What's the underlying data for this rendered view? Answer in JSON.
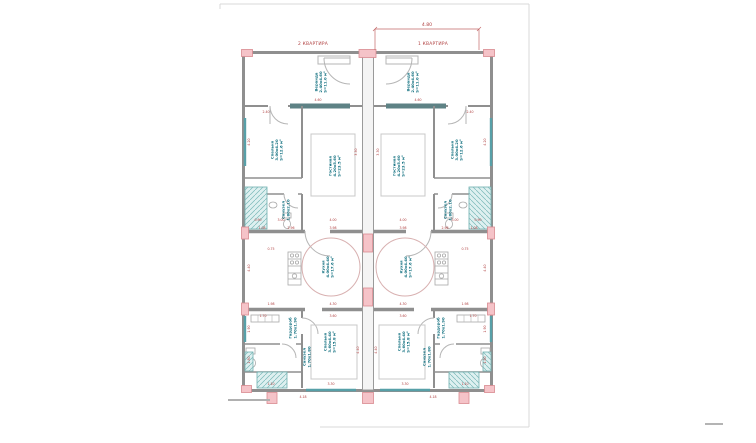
{
  "drawing": {
    "top_dimension": "4.80",
    "unit_labels": {
      "left": "2 КВАРТИРА",
      "right": "1 КВАРТИРА"
    }
  },
  "colors": {
    "dimension_red": "#b04040",
    "room_label_teal": "#0e6e7e",
    "column_pink": "#f5c3c8",
    "window_teal": "#57a0a8",
    "balcony_hatch": "#6fb0b0",
    "wall_gray": "#8f8f8f",
    "sheet_frame": "#d8d8d8"
  },
  "room_labels": [
    {
      "name": "Веранда",
      "dims": "2.40х4.60",
      "area": "S=11.0 м²",
      "x": 322,
      "y": 82,
      "rot": -90
    },
    {
      "name": "Веранда",
      "dims": "2.40х4.60",
      "area": "S=11.0 м²",
      "x": 414,
      "y": 82,
      "rot": -90
    },
    {
      "name": "Спальня",
      "dims": "3.00х4.20",
      "area": "S=12.6 м²",
      "x": 278,
      "y": 150,
      "rot": -90
    },
    {
      "name": "Спальня",
      "dims": "3.00х4.20",
      "area": "S=12.6 м²",
      "x": 458,
      "y": 150,
      "rot": -90
    },
    {
      "name": "Гостиная",
      "dims": "4.20х5.60",
      "area": "S=23.5 м²",
      "x": 336,
      "y": 166,
      "rot": -90
    },
    {
      "name": "Гостиная",
      "dims": "4.20х5.60",
      "area": "S=23.5 м²",
      "x": 400,
      "y": 166,
      "rot": -90
    },
    {
      "name": "Санузел",
      "dims": "1.80х2.10",
      "area": "",
      "x": 287,
      "y": 210,
      "rot": -90
    },
    {
      "name": "Санузел",
      "dims": "1.80х2.10",
      "area": "",
      "x": 449,
      "y": 210,
      "rot": -90
    },
    {
      "name": "Кухня",
      "dims": "4.00х4.40",
      "area": "S=17.6 м²",
      "x": 329,
      "y": 267,
      "rot": -90
    },
    {
      "name": "Кухня",
      "dims": "4.00х4.40",
      "area": "S=17.6 м²",
      "x": 407,
      "y": 267,
      "rot": -90
    },
    {
      "name": "Гардероб",
      "dims": "1.70х1.90",
      "area": "",
      "x": 294,
      "y": 328,
      "rot": -90
    },
    {
      "name": "Гардероб",
      "dims": "1.70х1.90",
      "area": "",
      "x": 442,
      "y": 328,
      "rot": -90
    },
    {
      "name": "Санузел",
      "dims": "1.70х1.80",
      "area": "",
      "x": 308,
      "y": 357,
      "rot": -90
    },
    {
      "name": "Санузел",
      "dims": "1.70х1.80",
      "area": "",
      "x": 428,
      "y": 357,
      "rot": -90
    },
    {
      "name": "Спальня",
      "dims": "3.60х4.40",
      "area": "S=15.8 м²",
      "x": 331,
      "y": 342,
      "rot": -90
    },
    {
      "name": "Спальня",
      "dims": "3.60х4.40",
      "area": "S=15.8 м²",
      "x": 405,
      "y": 342,
      "rot": -90
    }
  ],
  "dimensions": [
    {
      "t": "4.60",
      "x": 318,
      "y": 101
    },
    {
      "t": "4.60",
      "x": 418,
      "y": 101
    },
    {
      "t": "2.40",
      "x": 266,
      "y": 113
    },
    {
      "t": "2.40",
      "x": 470,
      "y": 113
    },
    {
      "t": "4.20",
      "x": 250,
      "y": 142,
      "r": -90
    },
    {
      "t": "4.20",
      "x": 486,
      "y": 142,
      "r": -90
    },
    {
      "t": "3.30",
      "x": 357,
      "y": 152,
      "r": -90
    },
    {
      "t": "3.30",
      "x": 379,
      "y": 152,
      "r": -90
    },
    {
      "t": "0.90",
      "x": 258,
      "y": 221
    },
    {
      "t": "0.90",
      "x": 478,
      "y": 221
    },
    {
      "t": "3.00",
      "x": 281,
      "y": 221
    },
    {
      "t": "3.00",
      "x": 455,
      "y": 221
    },
    {
      "t": "4.00",
      "x": 333,
      "y": 221
    },
    {
      "t": "4.00",
      "x": 403,
      "y": 221
    },
    {
      "t": "1.08",
      "x": 262,
      "y": 229
    },
    {
      "t": "1.08",
      "x": 474,
      "y": 229
    },
    {
      "t": "2.96",
      "x": 291,
      "y": 229
    },
    {
      "t": "2.96",
      "x": 445,
      "y": 229
    },
    {
      "t": "3.98",
      "x": 333,
      "y": 229
    },
    {
      "t": "3.98",
      "x": 403,
      "y": 229
    },
    {
      "t": "0.75",
      "x": 271,
      "y": 250
    },
    {
      "t": "0.75",
      "x": 465,
      "y": 250
    },
    {
      "t": "4.40",
      "x": 250,
      "y": 268,
      "r": -90
    },
    {
      "t": "4.40",
      "x": 486,
      "y": 268,
      "r": -90
    },
    {
      "t": "1.98",
      "x": 271,
      "y": 305
    },
    {
      "t": "1.98",
      "x": 465,
      "y": 305
    },
    {
      "t": "4.30",
      "x": 333,
      "y": 305
    },
    {
      "t": "4.30",
      "x": 403,
      "y": 305
    },
    {
      "t": "1.70",
      "x": 263,
      "y": 317
    },
    {
      "t": "1.70",
      "x": 473,
      "y": 317
    },
    {
      "t": "3.60",
      "x": 333,
      "y": 317
    },
    {
      "t": "3.60",
      "x": 403,
      "y": 317
    },
    {
      "t": "1.90",
      "x": 250,
      "y": 329,
      "r": -90
    },
    {
      "t": "1.90",
      "x": 486,
      "y": 329,
      "r": -90
    },
    {
      "t": "1.80",
      "x": 250,
      "y": 360,
      "r": -90
    },
    {
      "t": "1.80",
      "x": 486,
      "y": 360,
      "r": -90
    },
    {
      "t": "4.40",
      "x": 359,
      "y": 350,
      "r": -90
    },
    {
      "t": "4.40",
      "x": 377,
      "y": 350,
      "r": -90
    },
    {
      "t": "1.10",
      "x": 271,
      "y": 385
    },
    {
      "t": "1.10",
      "x": 465,
      "y": 385
    },
    {
      "t": "3.30",
      "x": 331,
      "y": 385
    },
    {
      "t": "3.30",
      "x": 405,
      "y": 385
    },
    {
      "t": "4.18",
      "x": 303,
      "y": 398
    },
    {
      "t": "4.18",
      "x": 433,
      "y": 398
    }
  ]
}
